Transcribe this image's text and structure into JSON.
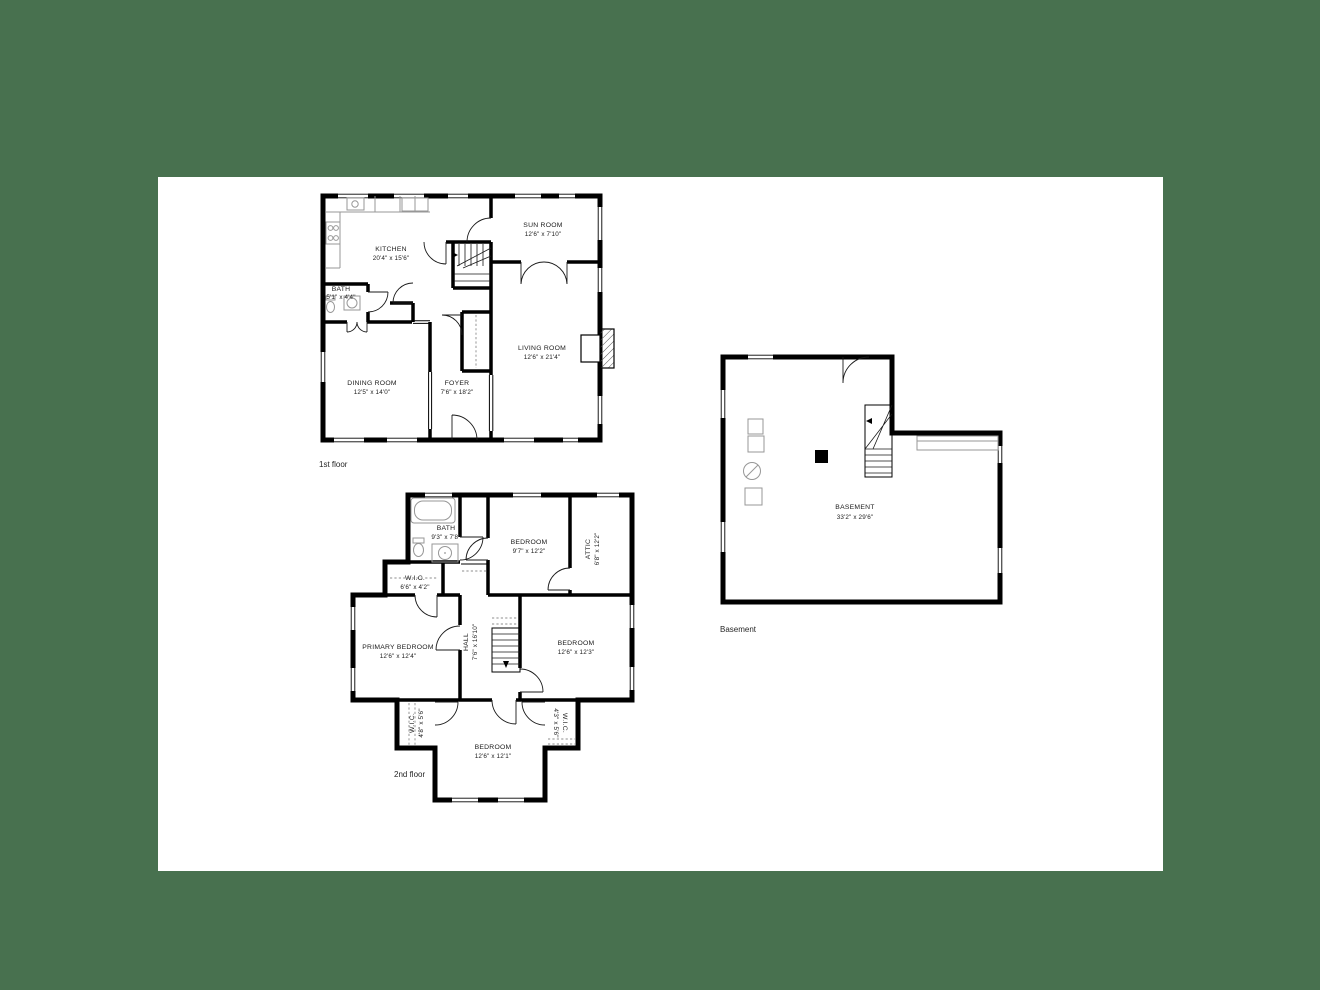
{
  "colors": {
    "background": "#48714F",
    "paper": "#FFFFFF",
    "linework": "#000000"
  },
  "floors": [
    {
      "caption": "1st floor",
      "rooms": [
        {
          "name": "KITCHEN",
          "dims": "20'4\" x 15'6\""
        },
        {
          "name": "SUN ROOM",
          "dims": "12'6\" x 7'10\""
        },
        {
          "name": "BATH",
          "dims": "5'1\" x 4'4\""
        },
        {
          "name": "DINING ROOM",
          "dims": "12'5\" x 14'0\""
        },
        {
          "name": "FOYER",
          "dims": "7'6\" x 18'2\""
        },
        {
          "name": "LIVING ROOM",
          "dims": "12'6\" x 21'4\""
        }
      ]
    },
    {
      "caption": "2nd floor",
      "rooms": [
        {
          "name": "BATH",
          "dims": "9'3\" x 7'8\""
        },
        {
          "name": "BEDROOM",
          "dims": "9'7\" x 12'2\""
        },
        {
          "name": "ATTIC",
          "dims": "6'8\" x 12'2\""
        },
        {
          "name": "W.I.C.",
          "dims": "6'6\" x 4'2\""
        },
        {
          "name": "PRIMARY BEDROOM",
          "dims": "12'6\" x 12'4\""
        },
        {
          "name": "HALL",
          "dims": "7'6\" x 16'10\""
        },
        {
          "name": "BEDROOM",
          "dims": "12'6\" x 12'3\""
        },
        {
          "name": "W.I.C.",
          "dims": "4'8\" x 5'6\""
        },
        {
          "name": "W.I.C.",
          "dims": "4'3\" x 5'6\""
        },
        {
          "name": "BEDROOM",
          "dims": "12'6\" x 12'1\""
        }
      ]
    },
    {
      "caption": "Basement",
      "rooms": [
        {
          "name": "BASEMENT",
          "dims": "33'2\" x 29'6\""
        }
      ]
    }
  ]
}
